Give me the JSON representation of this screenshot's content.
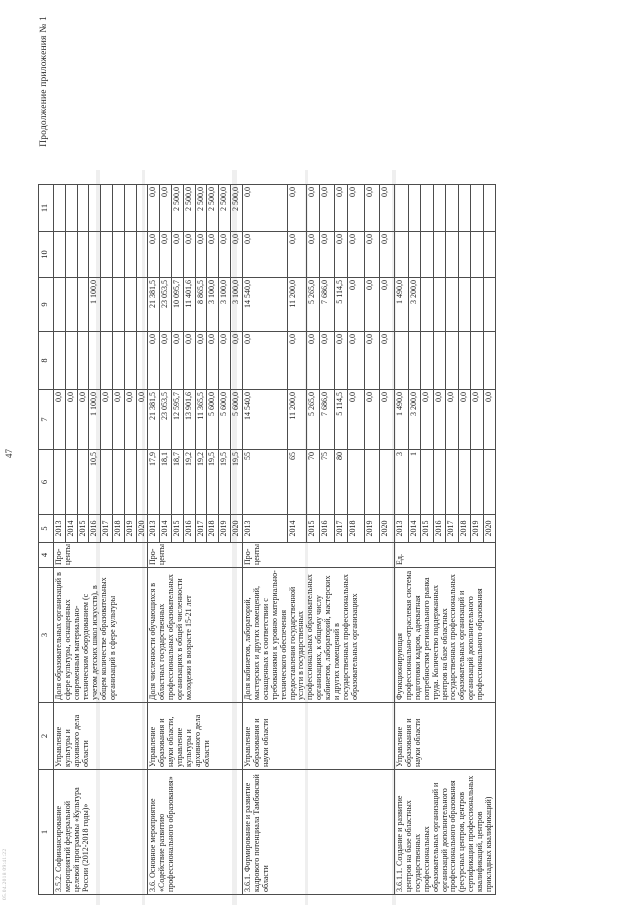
{
  "page": {
    "appendix_note": "Продолжение приложения № 1",
    "page_number": "47",
    "print_stamp": "05.04.2018 09:41:22"
  },
  "table": {
    "column_numbers": [
      "1",
      "2",
      "3",
      "4",
      "5",
      "6",
      "7",
      "8",
      "9",
      "10",
      "11"
    ],
    "groups": [
      {
        "name": "3.5.2. Софинансирование мероприятий федеральной целевой программы «Культура России (2012-2018 годы)»",
        "executor": "Управление культуры и архивного дела области",
        "indicator": "Доля образовательных организаций в сфере культуры, оснащенных современным материально-техническим оборудованием (с учетом детских школ искусств), в общем количестве образовательных организаций в сфере культуры",
        "unit": "Про-центы",
        "rows": [
          {
            "cells": [
              "2013",
              "",
              "0,0",
              "",
              "",
              "",
              ""
            ]
          },
          {
            "cells": [
              "2014",
              "",
              "0,0",
              "",
              "",
              "",
              ""
            ]
          },
          {
            "cells": [
              "2015",
              "",
              "0,0",
              "",
              "",
              "",
              ""
            ]
          },
          {
            "cells": [
              "2016",
              "10,5",
              "1 100,0",
              "",
              "1 100,0",
              "",
              ""
            ]
          },
          {
            "cells": [
              "2017",
              "",
              "0,0",
              "",
              "",
              "",
              ""
            ]
          },
          {
            "cells": [
              "2018",
              "",
              "0,0",
              "",
              "",
              "",
              ""
            ]
          },
          {
            "cells": [
              "2019",
              "",
              "0,0",
              "",
              "",
              "",
              ""
            ]
          },
          {
            "cells": [
              "2020",
              "",
              "0,0",
              "",
              "",
              "",
              ""
            ]
          }
        ]
      },
      {
        "name": "3.6. Основное мероприятие «Содействие развитию профессионального образования»",
        "executor": "Управление образования и науки области, управление культуры и архивного дела области",
        "indicator": "Доля численности обучающихся в областных государственных профессиональных образовательных организациях в общей численности молодежи в возрасте 15-21 лет",
        "unit": "Про-центы",
        "rows": [
          {
            "cells": [
              "2013",
              "17,9",
              "21 381,5",
              "0,0",
              "21 381,5",
              "0,0",
              "0,0"
            ]
          },
          {
            "cells": [
              "2014",
              "18,1",
              "23 053,5",
              "0,0",
              "23 053,5",
              "0,0",
              "0,0"
            ]
          },
          {
            "cells": [
              "2015",
              "18,7",
              "12 595,7",
              "0,0",
              "10 095,7",
              "0,0",
              "2 500,0"
            ]
          },
          {
            "cells": [
              "2016",
              "19,2",
              "13 901,6",
              "0,0",
              "11 401,6",
              "0,0",
              "2 500,0"
            ]
          },
          {
            "cells": [
              "2017",
              "19,2",
              "11 365,5",
              "0,0",
              "8 865,5",
              "0,0",
              "2 500,0"
            ]
          },
          {
            "cells": [
              "2018",
              "19,5",
              "5 600,0",
              "0,0",
              "3 100,0",
              "0,0",
              "2 500,0"
            ]
          },
          {
            "cells": [
              "2019",
              "19,5",
              "5 600,0",
              "0,0",
              "3 100,0",
              "0,0",
              "2 500,0"
            ]
          },
          {
            "cells": [
              "2020",
              "19,5",
              "5 600,0",
              "0,0",
              "3 100,0",
              "0,0",
              "2 500,0"
            ]
          }
        ]
      },
      {
        "name": "3.6.1. Формирование и развитие кадрового потенциала Тамбовской области",
        "executor": "Управление образования и науки области",
        "indicator": "Доля кабинетов, лабораторий, мастерских и других помещений, оснащенных в соответствии с требованиями к уровню материально-технического обеспечения предоставления государственной услуги в государственных профессиональных образовательных организациях, к общему числу кабинетов, лабораторий, мастерских и других помещений в государственных профессиональных образовательных организациях",
        "unit": "Про-центы",
        "rows": [
          {
            "cells": [
              "2013",
              "55",
              "14 540,0",
              "0,0",
              "14 540,0",
              "0,0",
              "0,0"
            ]
          },
          {
            "cells": [
              "2014",
              "65",
              "11 200,0",
              "0,0",
              "11 200,0",
              "0,0",
              "0,0"
            ]
          },
          {
            "cells": [
              "2015",
              "70",
              "5 265,0",
              "0,0",
              "5 265,0",
              "0,0",
              "0,0"
            ]
          },
          {
            "cells": [
              "2016",
              "75",
              "7 686,0",
              "0,0",
              "7 686,0",
              "0,0",
              "0,0"
            ]
          },
          {
            "cells": [
              "2017",
              "80",
              "5 114,5",
              "0,0",
              "5 114,5",
              "0,0",
              "0,0"
            ]
          },
          {
            "cells": [
              "2018",
              "",
              "0,0",
              "0,0",
              "0,0",
              "0,0",
              "0,0"
            ]
          },
          {
            "cells": [
              "2019",
              "",
              "0,0",
              "0,0",
              "0,0",
              "0,0",
              "0,0"
            ]
          },
          {
            "cells": [
              "2020",
              "",
              "0,0",
              "0,0",
              "0,0",
              "0,0",
              "0,0"
            ]
          }
        ]
      },
      {
        "name": "3.6.1.1. Создание и развитие центров на базе областных государственных профессиональных образовательных организаций и организаций дополнительного профессионального образования (ресурсных центров, центров сертификации профессиональных квалификаций, центров прикладных квалификаций)",
        "executor": "Управление образования и науки области",
        "indicator": "Функционирующая профессионально-отраслевая система подготовки кадров, адекватная потребностям регионального рынка труда. Количество поддержанных центров на базе областных государственных профессиональных образовательных организаций и организаций дополнительного профессионального образования",
        "unit": "Ед.",
        "rows": [
          {
            "cells": [
              "2013",
              "3",
              "1 490,0",
              "",
              "1 490,0",
              "",
              ""
            ]
          },
          {
            "cells": [
              "2014",
              "1",
              "3 200,0",
              "",
              "3 200,0",
              "",
              ""
            ]
          },
          {
            "cells": [
              "2015",
              "",
              "0,0",
              "",
              "",
              "",
              ""
            ]
          },
          {
            "cells": [
              "2016",
              "",
              "0,0",
              "",
              "",
              "",
              ""
            ]
          },
          {
            "cells": [
              "2017",
              "",
              "0,0",
              "",
              "",
              "",
              ""
            ]
          },
          {
            "cells": [
              "2018",
              "",
              "0,0",
              "",
              "",
              "",
              ""
            ]
          },
          {
            "cells": [
              "2019",
              "",
              "0,0",
              "",
              "",
              "",
              ""
            ]
          },
          {
            "cells": [
              "2020",
              "",
              "0,0",
              "",
              "",
              "",
              ""
            ]
          }
        ]
      }
    ]
  }
}
